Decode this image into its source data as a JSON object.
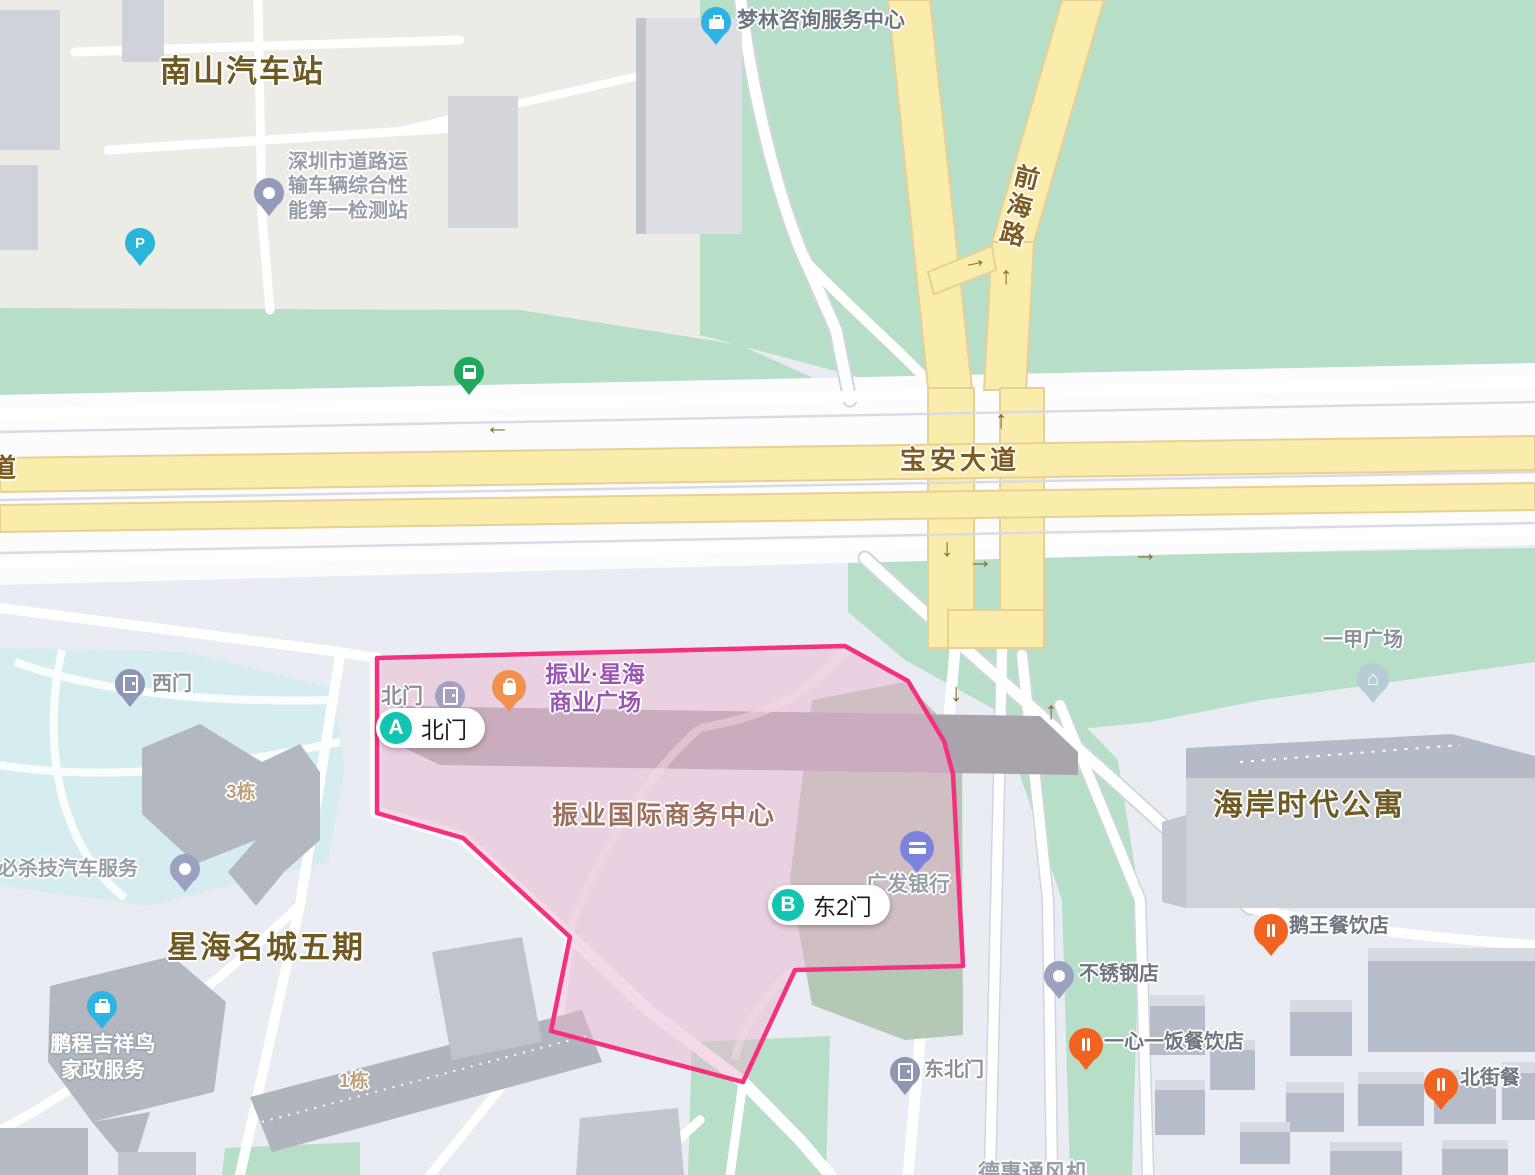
{
  "colors": {
    "highlight_border": "#f5317f",
    "highlight_fill": "#e9b6cf",
    "road_yellow": "#faecab",
    "green_area": "#b7dfc7",
    "marker_teal": "#13c4b3"
  },
  "road_labels": {
    "qianhai_road": "前海路",
    "baoan_avenue": "宝安大道",
    "left_edge_partial": "道"
  },
  "area_labels": {
    "nanshan_bus_station": "南山汽车站",
    "xinghai_mingcheng_phase5": "星海名城五期",
    "haian_times_apartment": "海岸时代公寓",
    "zhenye_intl_business_center": "振业国际商务中心",
    "building_3": "3栋",
    "building_1": "1栋"
  },
  "poi_labels": {
    "inspection_station": "深圳市道路运\n输车辆综合性\n能第一检测站",
    "menglin_consulting": "梦林咨询服务中心",
    "zhenye_xinghai_plaza": "振业·星海\n商业广场",
    "north_gate_small": "北门",
    "west_gate": "西门",
    "northeast_gate": "东北门",
    "guangfa_bank": "广发银行",
    "bishaji_auto_service": "必杀技汽车服务",
    "pengcheng_housekeeping": "鹏程吉祥鸟\n家政服务",
    "stainless_steel_shop": "不锈钢店",
    "yixinyifan_restaurant": "一心一饭餐饮店",
    "ewang_restaurant": "鹅王餐饮店",
    "beijie_restaurant_partial": "北街餐",
    "yijia_plaza": "一甲广场",
    "dehui_partial": "德惠通风机"
  },
  "markers": [
    {
      "letter": "A",
      "label": "北门"
    },
    {
      "letter": "B",
      "label": "东2门"
    }
  ],
  "icons": {
    "arrow_up": "↑",
    "arrow_down": "↓",
    "arrow_left": "←",
    "arrow_right": "→",
    "parking": "P",
    "house": "⌂"
  }
}
